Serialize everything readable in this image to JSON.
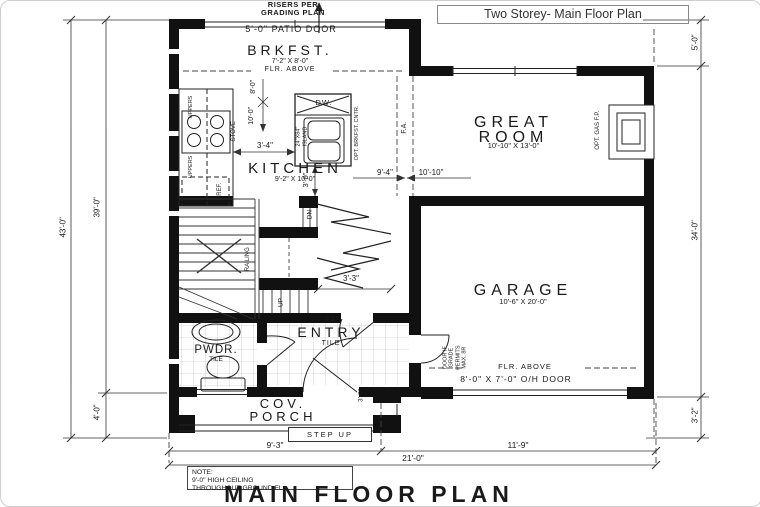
{
  "frame": {
    "title": "Two Storey- Main Floor Plan",
    "plan_title": "MAIN FLOOR PLAN"
  },
  "note": {
    "line1": "NOTE:",
    "line2": "9'-0\" HIGH CEILING",
    "line3": "THROUGHOUT GROUND FL."
  },
  "annotations": {
    "risers_line1": "RISERS PER",
    "risers_line2": "GRADING PLAN",
    "patio_door": "5'-0\" PATIO DOOR",
    "flr_above_brkfst": "FLR. ABOVE",
    "flr_above_garage": "FLR. ABOVE",
    "oh_door": "8'-0\" X 7'-0\" O/H DOOR",
    "grade_door_lines": [
      "DOOR IF",
      "GRADE",
      "PERMITS",
      "MAX. 8R"
    ],
    "opt_gas_fp": "OPT. GAS F.P.",
    "fa_passage": "F.A.",
    "fa_entry": "F.A."
  },
  "rooms": {
    "brkfst": {
      "name": "BRKFST.",
      "size": "7'-2\" X 8'-0\""
    },
    "kitchen": {
      "name": "KITCHEN",
      "size": "9'-2\" X 10'-0\""
    },
    "great_room": {
      "name_line1": "GREAT",
      "name_line2": "ROOM",
      "size": "10'-10\" X 13'-0\""
    },
    "garage": {
      "name": "GARAGE",
      "size": "10'-6\" X 20'-0\""
    },
    "entry": {
      "name": "ENTRY",
      "floor": "TILE"
    },
    "pwdr": {
      "name": "PWDR.",
      "floor": "TILE"
    },
    "porch": {
      "name_line1": "COV.",
      "name_line2": "PORCH",
      "step": "STEP UP"
    }
  },
  "fixtures": {
    "dw": "DW.",
    "island_line1": "24\"X84\"",
    "island_line2": "ISLAND",
    "opt_brkfst_cntr": "OPT. BRKFST. CNTR.",
    "stove": "STOVE",
    "uppers_top": "UPPERS",
    "uppers_bottom": "UPPERS",
    "ref": "REF.",
    "railing": "RAILING",
    "dn": "DN",
    "up": "UP"
  },
  "dimensions": {
    "left_outer": "43'-0\"",
    "left_inner": "39'-0\"",
    "left_bottom": "4'-0\"",
    "right_top": "5'-0\"",
    "right_mid": "34'-0\"",
    "right_bottom": "3'-2\"",
    "bottom_left": "9'-3\"",
    "bottom_right": "11'-9\"",
    "bottom_total": "21'-0\"",
    "counter_gap": "3'-4\"",
    "pass_vert": "3'-0\"",
    "vert_upper": "8'-0\"",
    "vert_lower": "10'-0\"",
    "kitchen_width": "9'-4\"",
    "great_width": "10'-10\"",
    "closet_width": "3'-3\"",
    "entry_door": "3'-0\""
  },
  "colors": {
    "wall": "#111111",
    "line": "#222222",
    "dim": "#333333"
  }
}
